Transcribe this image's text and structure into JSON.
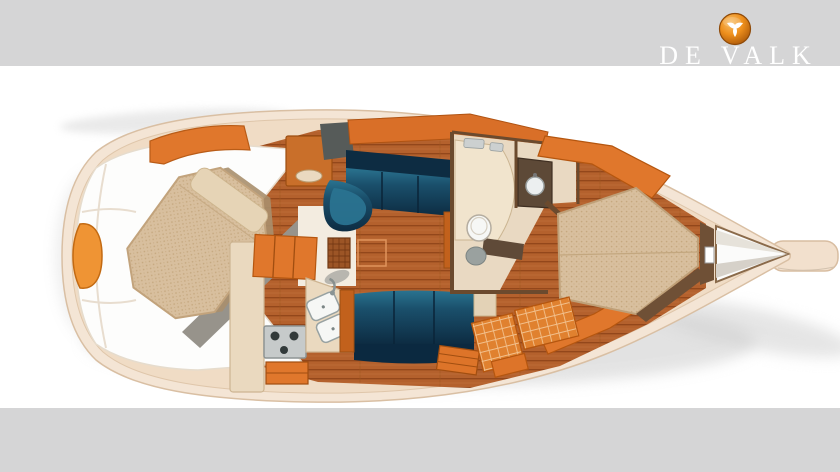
{
  "header": {
    "brand_text": "DE VALK",
    "logo_icon": "falcon-icon"
  },
  "colors": {
    "band_gray": "#d5d5d6",
    "text_white": "#ffffff",
    "logo_orange": "#ee8f1c",
    "logo_orange_dark": "#9c4c05",
    "hull_cream": "#f4e5d5",
    "hull_line": "#d9bfa3",
    "interior_cream": "#f0dcc5",
    "deck_white": "#fdfdfc",
    "deck_seam": "#e8ddcf",
    "wood_floor": "#b4612d",
    "wood_plank_line": "#93471b",
    "furniture_orange": "#e0772c",
    "furniture_orange_dark": "#b5560f",
    "cushion_blue_dark": "#0d2c42",
    "cushion_blue_light": "#2a7390",
    "mattress_beige": "#d8bf9e",
    "mattress_edge": "#c2a37c",
    "bulkhead_gray": "#97938b",
    "slate_panel": "#565b59",
    "head_floor": "#e9d9c2",
    "wall_brown": "#6b4a2e",
    "vanity_brown": "#5d4937",
    "fixture_white": "#f6f7f5",
    "fixture_gray": "#9aa19f",
    "stove_gray": "#c6caca",
    "burner_dark": "#323a3a",
    "shadow_gray": "#c7c7c7"
  },
  "floorplan": {
    "type": "yacht-interior-deck-plan",
    "orientation": "bow-right",
    "areas": [
      "swim-platform",
      "cockpit",
      "aft-cabin-double-berth",
      "galley",
      "salon-l-settee",
      "salon-settee",
      "saloon-table",
      "head-with-shower",
      "vanity",
      "v-berth",
      "anchor-locker",
      "bowsprit",
      "companionway-steps",
      "nav-cabinets"
    ]
  }
}
